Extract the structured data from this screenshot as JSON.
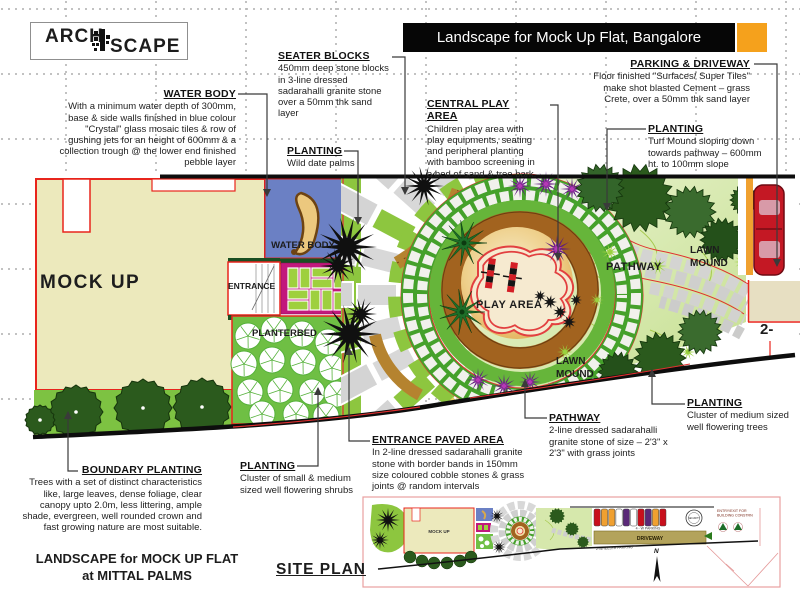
{
  "logo": {
    "part1": "ARCH",
    "part2": "SCAPE"
  },
  "banner": {
    "title": "Landscape for Mock Up Flat, Bangalore"
  },
  "notes": {
    "water_body": {
      "title": "WATER BODY",
      "body": "With a minimum water depth of 300mm, base & side walls finished in blue colour \"Crystal\" glass mosaic tiles & row of gushing jets for an height of 600mm & a collection trough @ the lower end finished pebble layer"
    },
    "seater_blocks": {
      "title": "SEATER BLOCKS",
      "body": "450mm deep stone blocks in 3-line dressed sadarahalli granite stone over a 50mm thk sand layer"
    },
    "central_play_area": {
      "title": "CENTRAL PLAY AREA",
      "body": "Children play area with play equipments, seating and peripheral planting with bamboo screening in a bed of sand & tree bark."
    },
    "parking_driveway": {
      "title": "PARKING & DRIVEWAY",
      "body": "Floor finished \"Surfaces/ Super Tiles\" make shot blasted Cement – grass Crete, over a 50mm thk sand layer"
    },
    "planting_turf": {
      "title": "PLANTING",
      "body": "Turf Mound sloping down towards pathway – 600mm ht. to 100mm slope"
    },
    "planting_palms": {
      "title": "PLANTING",
      "body": "Wild date palms"
    },
    "pathway": {
      "title": "PATHWAY",
      "body": "2-line dressed sadarahalli granite stone of size – 2'3\" x 2'3\" with grass joints"
    },
    "planting_trees": {
      "title": "PLANTING",
      "body": "Cluster of medium sized well flowering trees"
    },
    "entrance_paved": {
      "title": "ENTRANCE PAVED AREA",
      "body": "In 2-line dressed sadarahalli granite stone with border bands in 150mm size coloured cobble stones & grass joints @ random intervals"
    },
    "planting_shrubs": {
      "title": "PLANTING",
      "body": "Cluster of small & medium sized well flowering shrubs"
    },
    "boundary_planting": {
      "title": "BOUNDARY PLANTING",
      "body": "Trees with a set of distinct characteristics like, large leaves, dense foliage, clear canopy upto 2.0m, less littering, ample shade, evergreen, well rounded crown and fast growing nature are most suitable."
    }
  },
  "plan_labels": {
    "building": "MOCK UP",
    "water_body": "WATER BODY",
    "entrance": "ENTRANCE",
    "planterbed": "PLANTERBED",
    "play_area": "PLAY AREA",
    "pathway": "PATHWAY",
    "lawn_mound_upper": "LAWN MOUND",
    "lawn_mound_lower": "LAWN MOUND",
    "edge_note": "2-"
  },
  "footer": {
    "project_title_line1": "LANDSCAPE for MOCK UP FLAT",
    "project_title_line2": "at MITTAL PALMS",
    "site_plan_label": "SITE PLAN"
  },
  "inset": {
    "building": "MOCK UP",
    "driveway": "DRIVEWAY",
    "parking_4w": "4 - W PARKING",
    "parking_2w": "2-WHEELER PARKING",
    "security": "SECURITY",
    "entry_line1": "ENTRY/EXIT FOR",
    "entry_line2": "BUILDING CONSTRN",
    "north": "N"
  },
  "colors": {
    "banner_bg": "#060606",
    "accent_orange": "#F5A11C",
    "boundary_red": "#E8251C",
    "building_fill": "#ECE9BC",
    "water_blue": "#6B80C4",
    "paving_magenta": "#C2187C",
    "plaza_green": "#8DC63F",
    "planterbed_green": "#6FBF44",
    "lawn_light": "#D9EBAE",
    "seater_brown": "#A2631F",
    "cobble_grey": "#D8D8D8",
    "tree_dark": "#2B5A1D",
    "flower_purple": "#6A1F8A",
    "car_red": "#C41824"
  }
}
